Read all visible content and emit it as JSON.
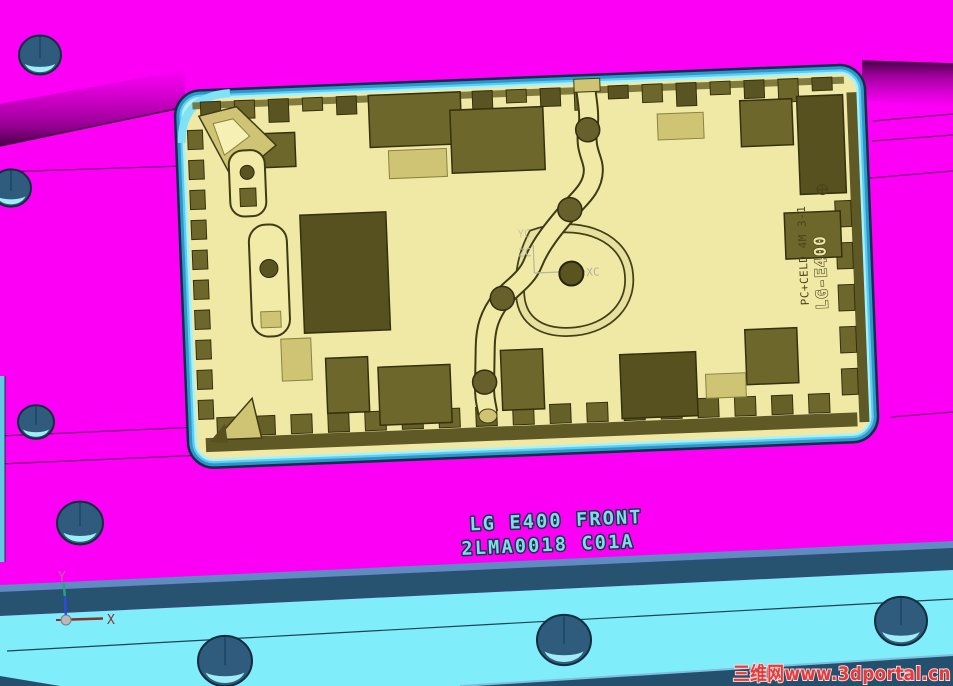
{
  "engraving": {
    "line1": "LG E400 FRONT",
    "line2": "2LMA0018 C01A"
  },
  "cavity_marking": {
    "model": "LG-E400",
    "spec": "PC+CELD 4M 3-1"
  },
  "wcs_center": {
    "y": "YC",
    "z": "ZC",
    "x": "XC"
  },
  "wcs_origin": {
    "y": "Y",
    "x": "X"
  },
  "watermark": {
    "cn": "三维网",
    "url": "www.3dportal.cn"
  },
  "colors": {
    "plate_magenta": "#fb00f5",
    "plate_shadow": "#4a0048",
    "base_cyan": "#7fedfa",
    "base_edge_dark_blue": "#275371",
    "base_edge_light_blue": "#5d8cc0",
    "cavity_khaki": "#f0e9a6",
    "cavity_midtone": "#cfc473",
    "pocket_olive": "#6e672c",
    "pocket_dark": "#56511f",
    "cavity_border_blue": "#2f93cc",
    "cavity_border_cyan": "#5ecdec",
    "hole_fill": "#2f5c7c",
    "hole_crescent": "#9feef7",
    "engraving_cyan": "#8ad6ea",
    "watermark_red": "#e23c3c",
    "wcs_gray": "#b8b4a2",
    "axis_x_red": "#8b2f2f",
    "axis_z_blue": "#2b4bdd",
    "axis_y_teal": "#2aa07a"
  }
}
